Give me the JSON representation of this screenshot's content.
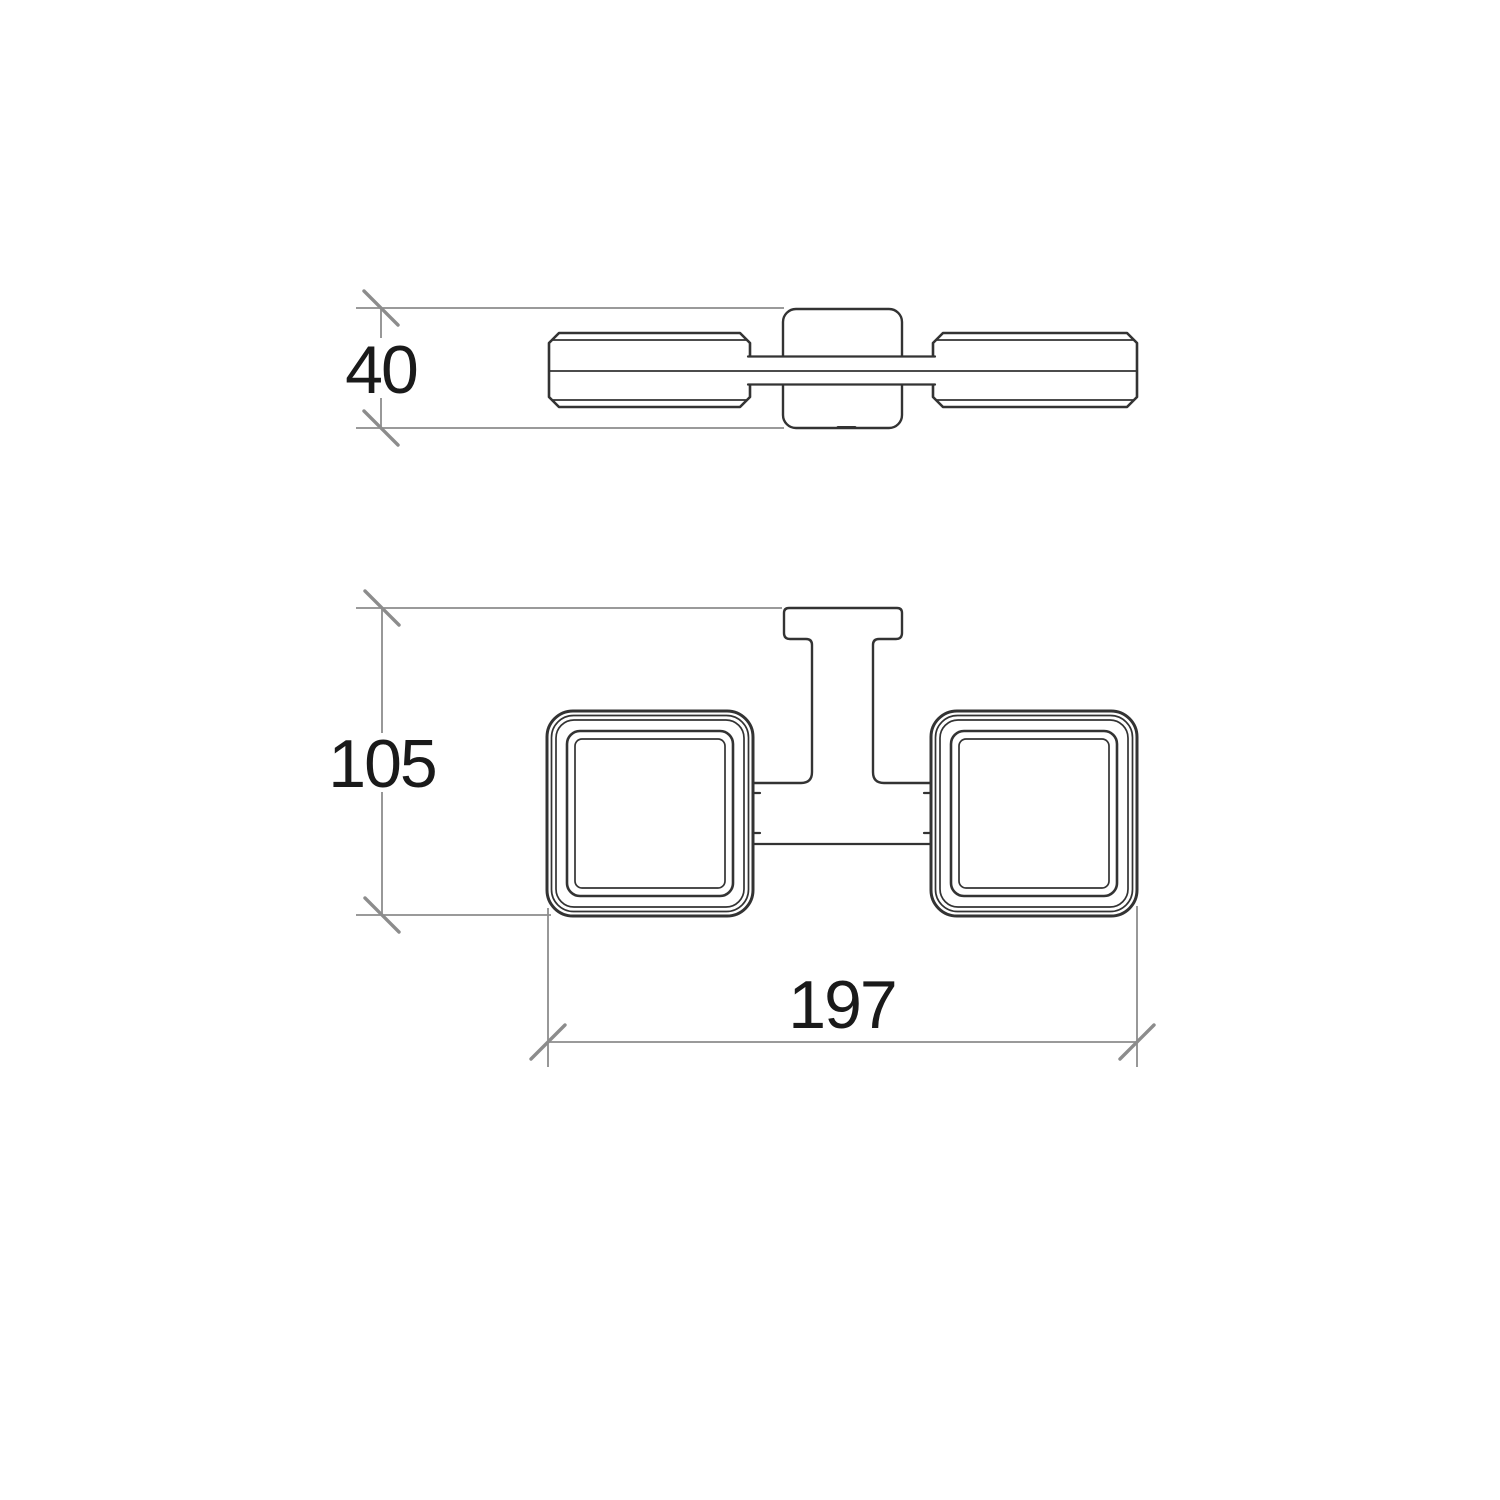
{
  "drawing": {
    "type": "technical-dimension-drawing",
    "background": "#ffffff",
    "colors": {
      "part_outline": "#333333",
      "dimension_line": "#8c8c8c",
      "dimension_text": "#1a1a1a"
    },
    "views": {
      "top": {
        "dimension": {
          "value": "40"
        }
      },
      "front": {
        "dimensions": {
          "height": "105",
          "width": "197"
        }
      }
    }
  }
}
